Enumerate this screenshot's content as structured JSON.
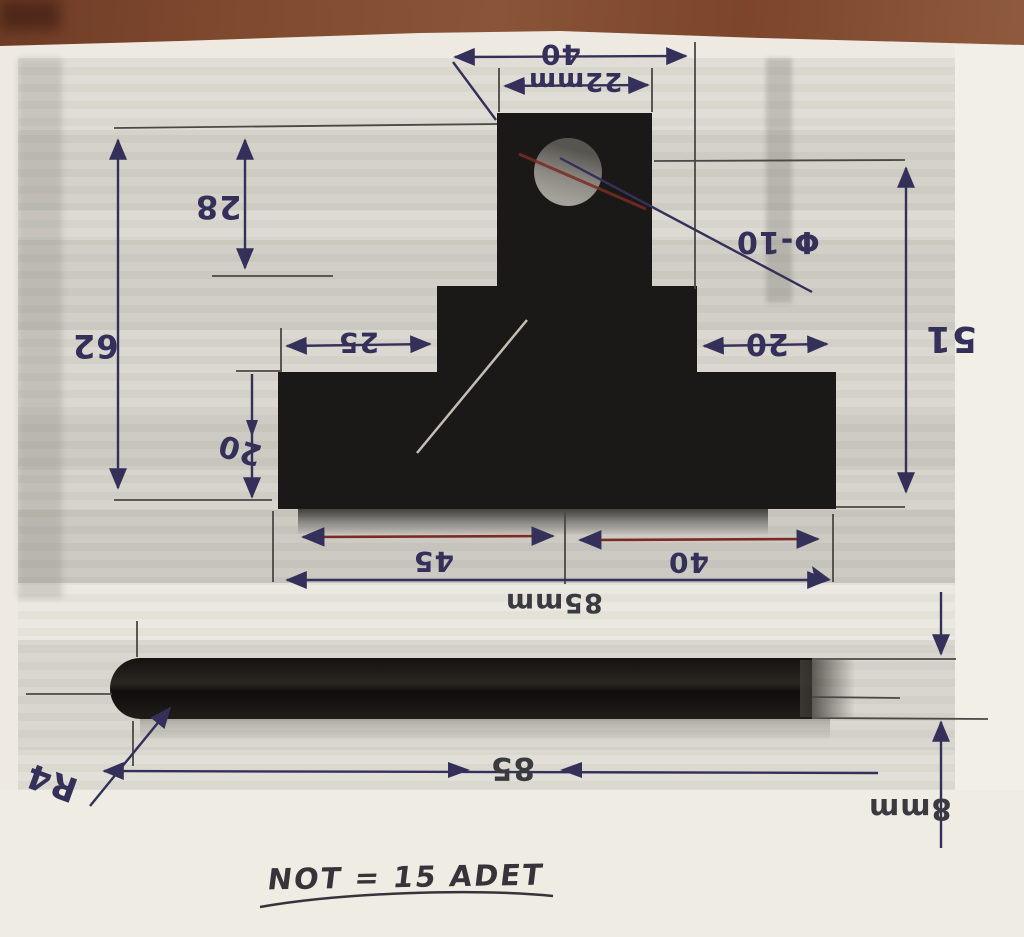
{
  "document": {
    "kind": "hand-annotated machining drawing photo",
    "note": {
      "text": "NOT = 15 ADET"
    }
  },
  "dims": {
    "top_width": "40",
    "tab_width": "22mm",
    "tab_height": "28",
    "left_height": "62",
    "hole_dia": "Φ-10",
    "step_left": "25",
    "step_right": "20",
    "right_height": "51",
    "base_height": "20",
    "base_seg_left": "45",
    "base_seg_right": "40",
    "base_total": "85mm",
    "bar_length": "85",
    "bar_thickness": "8mm",
    "corner_radius": "R4"
  },
  "colors": {
    "pen_ink": "#35305a",
    "red_ink": "#7b2b24",
    "wood": "#83492e",
    "paper": "#eeeae1",
    "part": "#1b1917"
  }
}
